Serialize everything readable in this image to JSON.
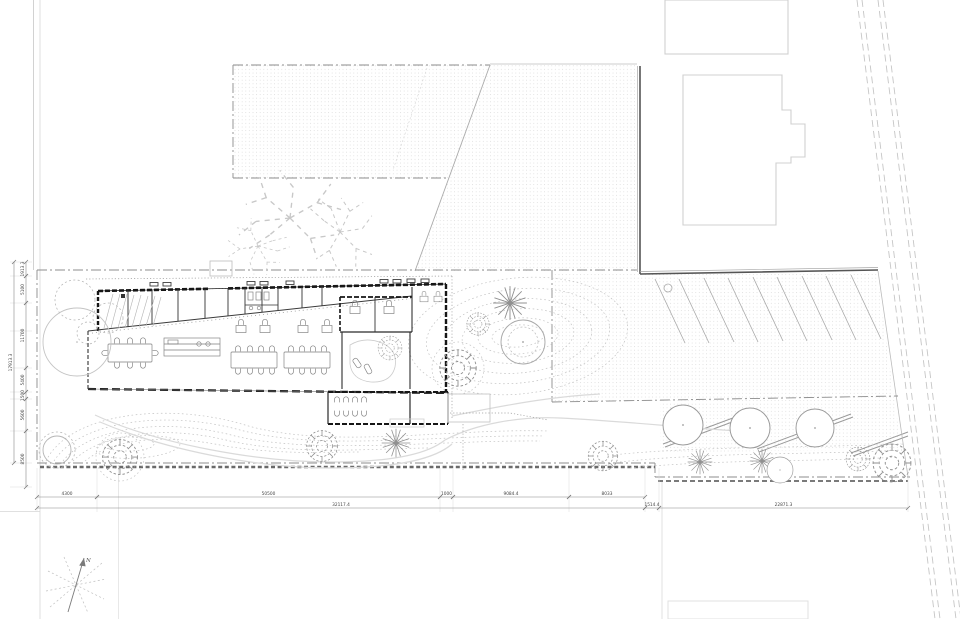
{
  "north": {
    "label": "N"
  },
  "dimensions": {
    "bottom_primary": [
      {
        "label": "4300",
        "x1": 37,
        "x2": 97
      },
      {
        "label": "50500",
        "x1": 97,
        "x2": 440
      },
      {
        "label": "1000",
        "x1": 440,
        "x2": 453
      },
      {
        "label": "9084.4",
        "x1": 453,
        "x2": 569
      },
      {
        "label": "8033",
        "x1": 569,
        "x2": 645
      }
    ],
    "bottom_totals": [
      {
        "label": "32117.4",
        "x1": 37,
        "x2": 645
      },
      {
        "label": "1514.4",
        "x1": 645,
        "x2": 659
      },
      {
        "label": "22871.3",
        "x1": 659,
        "x2": 908
      }
    ],
    "left_segments": [
      {
        "label": "1913.3",
        "y1": 262,
        "y2": 276
      },
      {
        "label": "5100",
        "y1": 276,
        "y2": 303
      },
      {
        "label": "11700",
        "y1": 303,
        "y2": 368
      },
      {
        "label": "5400",
        "y1": 368,
        "y2": 392
      },
      {
        "label": "1500",
        "y1": 392,
        "y2": 399
      },
      {
        "label": "5600",
        "y1": 399,
        "y2": 431
      },
      {
        "label": "8500",
        "y1": 431,
        "y2": 487
      }
    ],
    "left_total": [
      {
        "label": "17913.3",
        "y1": 262,
        "y2": 463
      }
    ]
  },
  "colors": {
    "wall_ink": "#161616",
    "boundary_gray": "#8c8c8c",
    "hatch_dot": "#cfcfcf",
    "landscape_gray": "#c2c2c2"
  }
}
